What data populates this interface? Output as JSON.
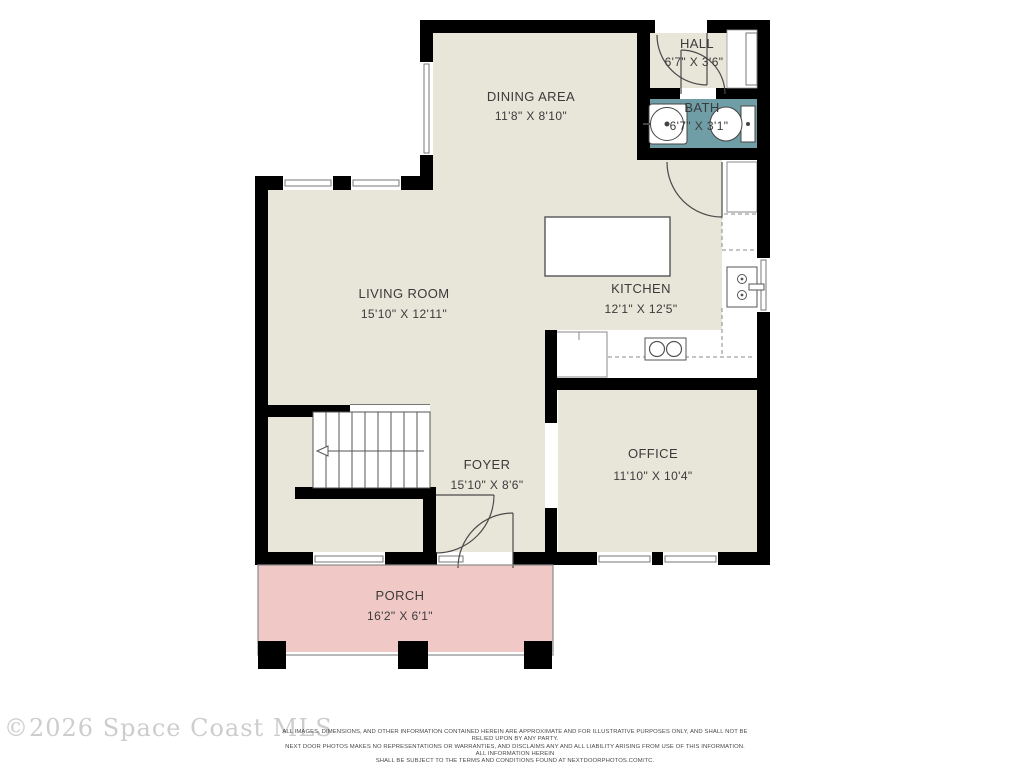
{
  "plan": {
    "rooms": [
      {
        "name": "DINING AREA",
        "dims": "11'8\" X 8'10\""
      },
      {
        "name": "HALL",
        "dims": "6'7\" X 3'6\""
      },
      {
        "name": "BATH",
        "dims": "6'7\" X 3'1\""
      },
      {
        "name": "LIVING ROOM",
        "dims": "15'10\" X 12'11\""
      },
      {
        "name": "KITCHEN",
        "dims": "12'1\" X 12'5\""
      },
      {
        "name": "FOYER",
        "dims": "15'10\" X 8'6\""
      },
      {
        "name": "OFFICE",
        "dims": "11'10\" X 10'4\""
      },
      {
        "name": "PORCH",
        "dims": "16'2\" X 6'1\""
      }
    ],
    "colors": {
      "floor": "#e8e5d9",
      "bath_fill": "#6f9ea7",
      "porch_fill": "#f0c9c7",
      "wall": "#000000"
    }
  },
  "footer": {
    "watermark": "©2026 Space Coast MLS",
    "disclaimer": [
      "ALL IMAGES, DIMENSIONS, AND OTHER INFORMATION CONTAINED HEREIN ARE APPROXIMATE AND FOR ILLUSTRATIVE PURPOSES ONLY, AND SHALL NOT BE RELIED UPON BY ANY PARTY.",
      "NEXT DOOR PHOTOS MAKES NO REPRESENTATIONS OR WARRANTIES, AND DISCLAIMS ANY AND ALL LIABILITY ARISING FROM USE OF THIS INFORMATION. ALL INFORMATION HEREIN",
      "SHALL BE SUBJECT TO THE TERMS AND CONDITIONS FOUND AT NEXTDOORPHOTOS.COM/TC."
    ]
  }
}
